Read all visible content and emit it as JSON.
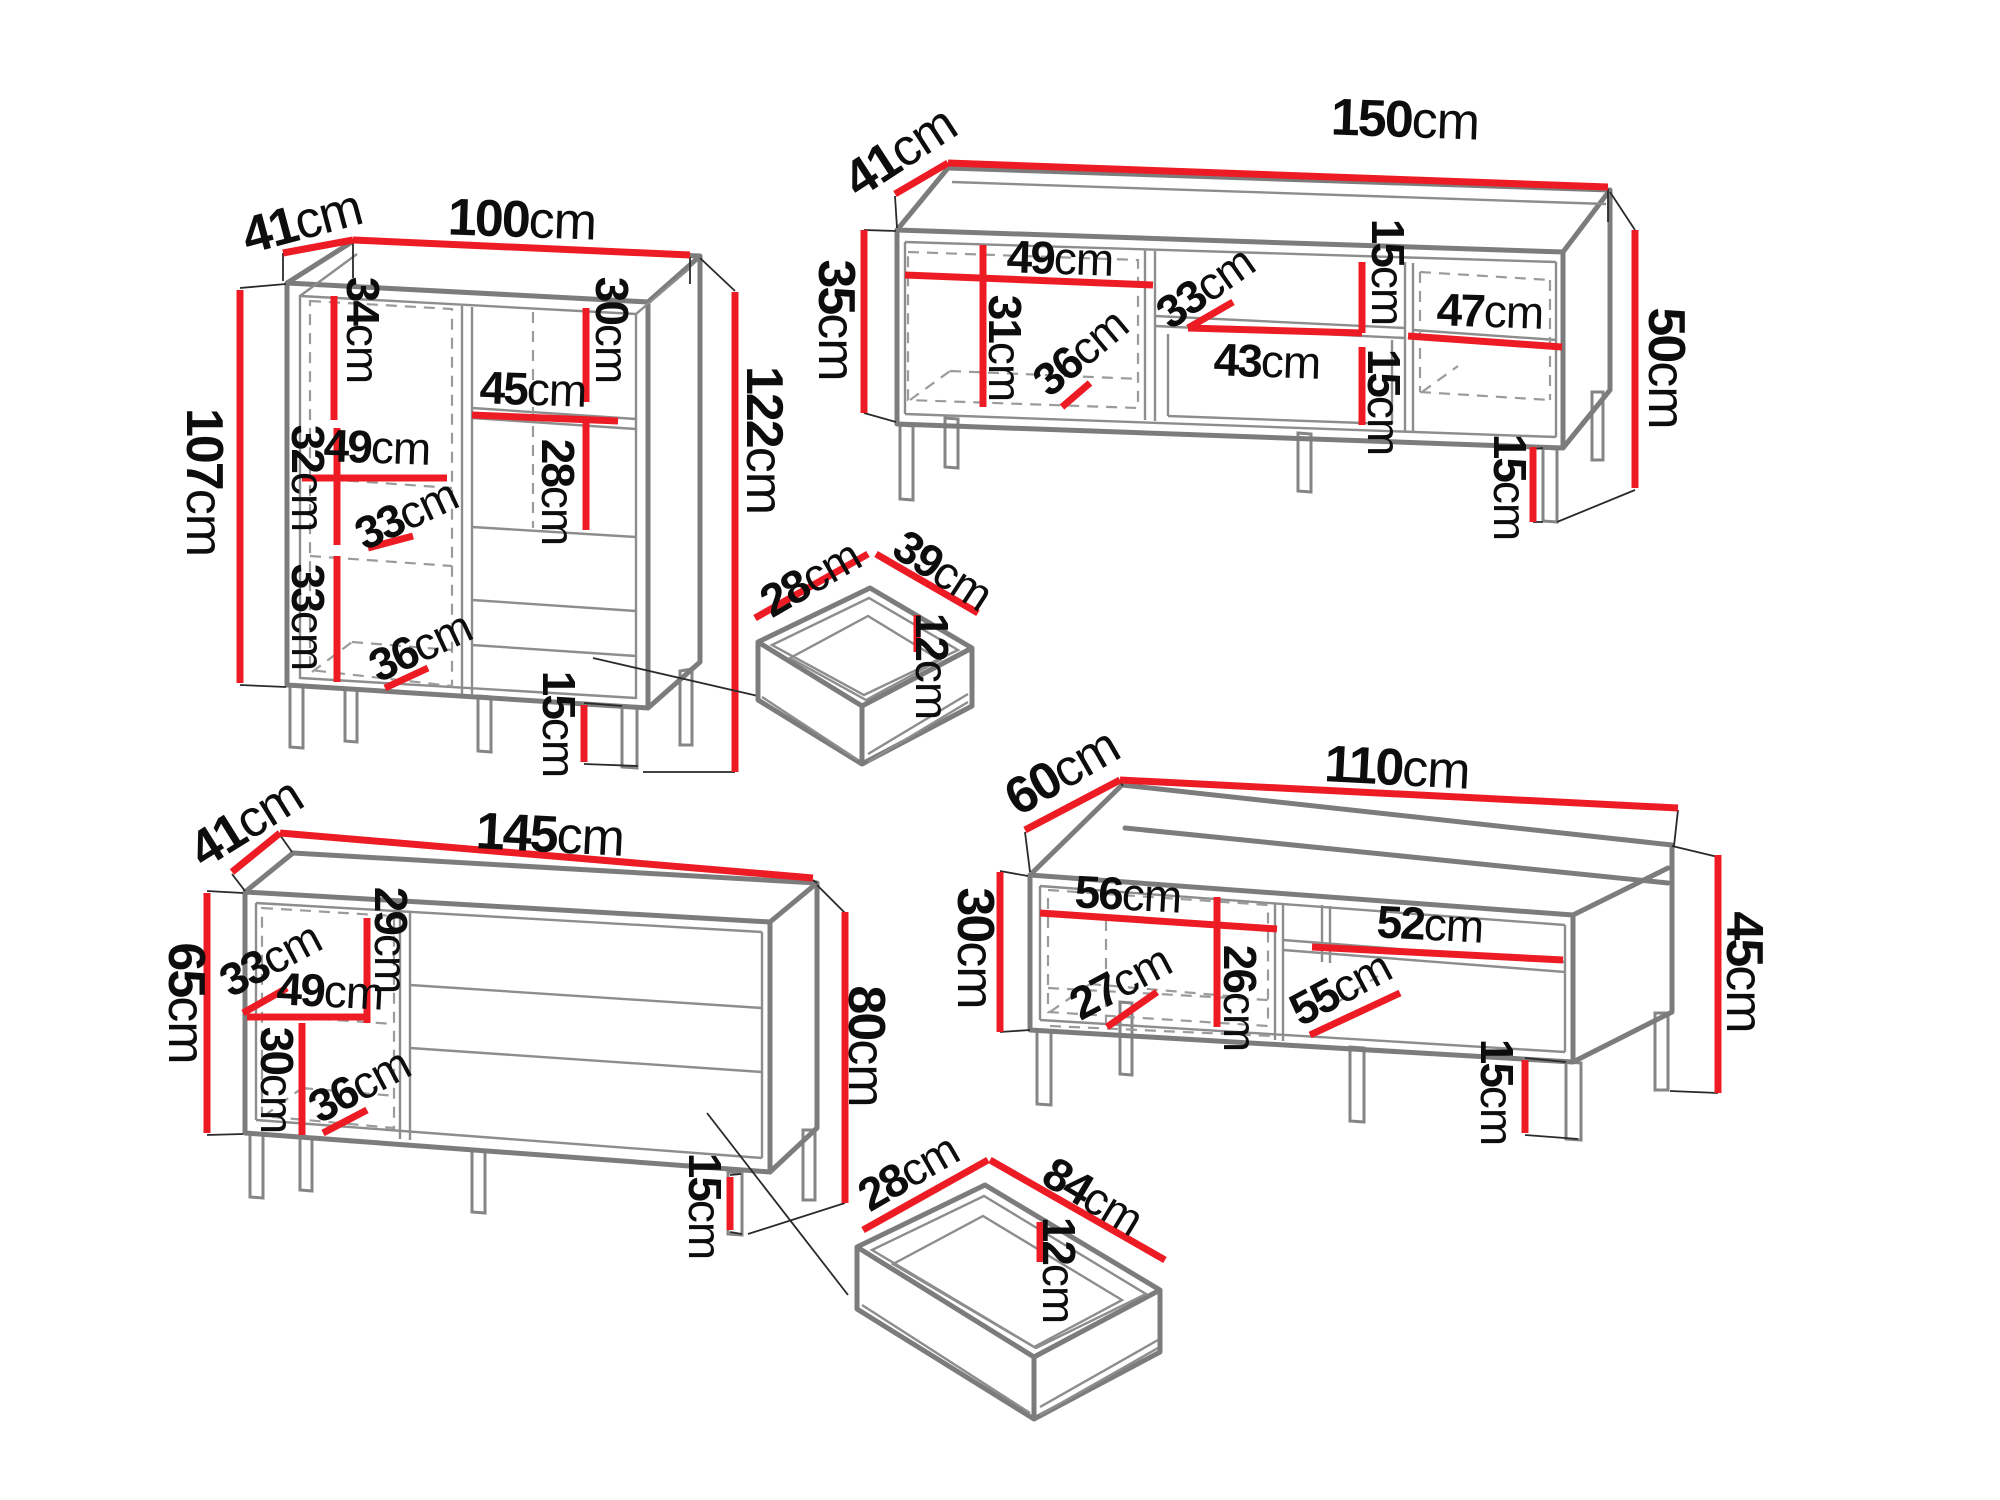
{
  "unit": "cm",
  "colors": {
    "dimension_line": "#ed1c24",
    "furniture_line": "#7c7c7c",
    "hidden_line": "#9b9b9b",
    "label_text": "#0d0d0d",
    "background": "#ffffff"
  },
  "pieces": {
    "cabinet_100": {
      "dims": {
        "depth": {
          "v": "41",
          "u": "cm"
        },
        "width": {
          "v": "100",
          "u": "cm"
        },
        "body_height": {
          "v": "107",
          "u": "cm"
        },
        "shelf_top": {
          "v": "34",
          "u": "cm"
        },
        "shelf_middle": {
          "v": "32",
          "u": "cm"
        },
        "shelf_bottom": {
          "v": "33",
          "u": "cm"
        },
        "left_width": {
          "v": "49",
          "u": "cm"
        },
        "right_width": {
          "v": "45",
          "u": "cm"
        },
        "right_top": {
          "v": "30",
          "u": "cm"
        },
        "right_middle": {
          "v": "28",
          "u": "cm"
        },
        "door_depth": {
          "v": "33",
          "u": "cm"
        },
        "inner_depth": {
          "v": "36",
          "u": "cm"
        },
        "total_height": {
          "v": "122",
          "u": "cm"
        },
        "legs": {
          "v": "15",
          "u": "cm"
        }
      }
    },
    "tv_stand_150": {
      "dims": {
        "depth": {
          "v": "41",
          "u": "cm"
        },
        "width": {
          "v": "150",
          "u": "cm"
        },
        "left_height": {
          "v": "35",
          "u": "cm"
        },
        "door_width": {
          "v": "49",
          "u": "cm"
        },
        "door_height": {
          "v": "31",
          "u": "cm"
        },
        "door_depth": {
          "v": "36",
          "u": "cm"
        },
        "shelf_depth": {
          "v": "33",
          "u": "cm"
        },
        "middle_width": {
          "v": "43",
          "u": "cm"
        },
        "drawer_upper": {
          "v": "15",
          "u": "cm"
        },
        "drawer_lower": {
          "v": "15",
          "u": "cm"
        },
        "right_width": {
          "v": "47",
          "u": "cm"
        },
        "total_height": {
          "v": "50",
          "u": "cm"
        },
        "legs": {
          "v": "15",
          "u": "cm"
        }
      }
    },
    "drawer_small": {
      "dims": {
        "width": {
          "v": "28",
          "u": "cm"
        },
        "depth": {
          "v": "39",
          "u": "cm"
        },
        "height": {
          "v": "12",
          "u": "cm"
        }
      }
    },
    "sideboard_145": {
      "dims": {
        "depth": {
          "v": "41",
          "u": "cm"
        },
        "width": {
          "v": "145",
          "u": "cm"
        },
        "left_height": {
          "v": "65",
          "u": "cm"
        },
        "door_depth": {
          "v": "33",
          "u": "cm"
        },
        "door_width": {
          "v": "49",
          "u": "cm"
        },
        "upper_height": {
          "v": "29",
          "u": "cm"
        },
        "lower_height": {
          "v": "30",
          "u": "cm"
        },
        "inner_depth": {
          "v": "36",
          "u": "cm"
        },
        "total_height": {
          "v": "80",
          "u": "cm"
        },
        "legs": {
          "v": "15",
          "u": "cm"
        }
      }
    },
    "tv_bench_110": {
      "dims": {
        "depth": {
          "v": "60",
          "u": "cm"
        },
        "width": {
          "v": "110",
          "u": "cm"
        },
        "left_height": {
          "v": "30",
          "u": "cm"
        },
        "door_width": {
          "v": "56",
          "u": "cm"
        },
        "door_depth": {
          "v": "27",
          "u": "cm"
        },
        "door_height": {
          "v": "26",
          "u": "cm"
        },
        "shelf_depth": {
          "v": "55",
          "u": "cm"
        },
        "right_width": {
          "v": "52",
          "u": "cm"
        },
        "total_height": {
          "v": "45",
          "u": "cm"
        },
        "legs": {
          "v": "15",
          "u": "cm"
        }
      }
    },
    "drawer_large": {
      "dims": {
        "width": {
          "v": "28",
          "u": "cm"
        },
        "depth": {
          "v": "84",
          "u": "cm"
        },
        "height": {
          "v": "12",
          "u": "cm"
        }
      }
    }
  }
}
